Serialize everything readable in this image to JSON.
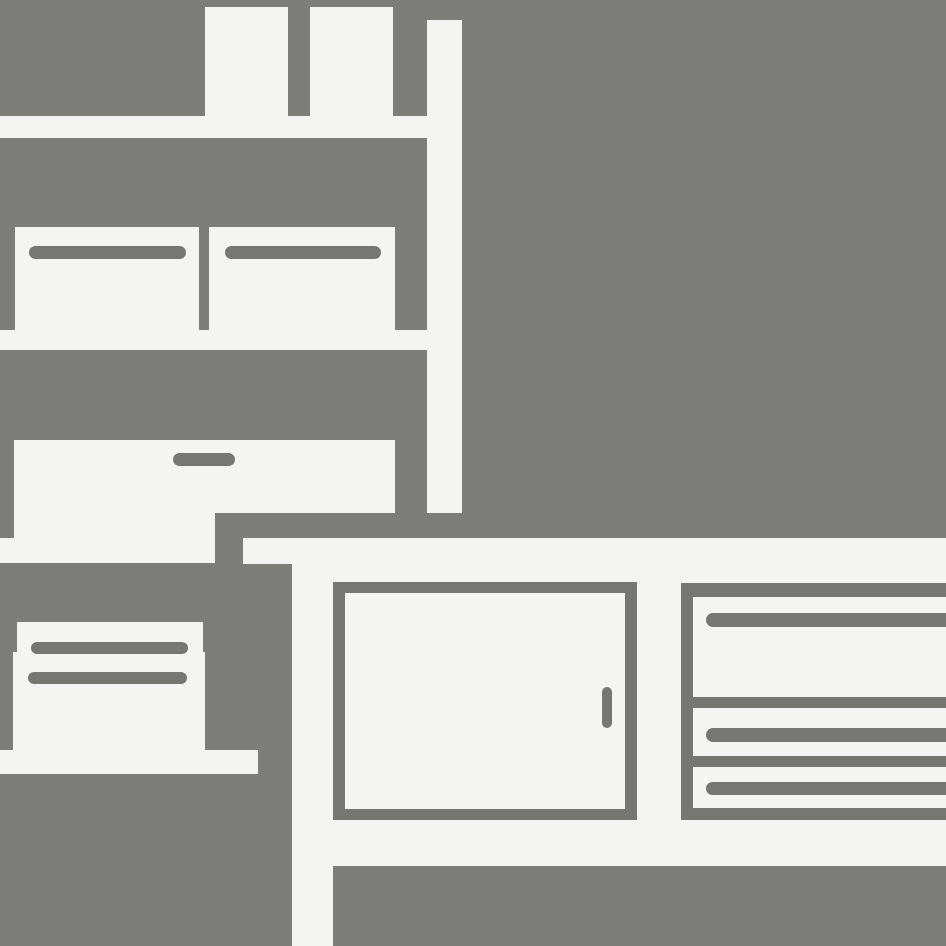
{
  "scene": {
    "description": "Flat grayscale pictogram of office furniture: bookshelf with books and storage boxes, a printer standing on the floor, and a sideboard cabinet with a hinged door and three drawers",
    "canvas": {
      "width": 946,
      "height": 946
    },
    "colors": {
      "background": "#7d7d7a",
      "shape": "#f4f4f2",
      "detail": "#767673"
    }
  },
  "objects": [
    {
      "group": "bookshelf",
      "name": "book-1",
      "fill": "shape",
      "x": 205,
      "y": 7,
      "w": 83,
      "h": 109,
      "r": "0"
    },
    {
      "group": "bookshelf",
      "name": "book-2",
      "fill": "shape",
      "x": 310,
      "y": 7,
      "w": 83,
      "h": 109,
      "r": "0"
    },
    {
      "group": "bookshelf",
      "name": "shelf-side-panel",
      "fill": "shape",
      "x": 427,
      "y": 20,
      "w": 35,
      "h": 493,
      "r": "0"
    },
    {
      "group": "bookshelf",
      "name": "shelf-board-upper",
      "fill": "shape",
      "x": 0,
      "y": 116,
      "w": 427,
      "h": 22,
      "r": "0"
    },
    {
      "group": "bookshelf",
      "name": "storage-box-left",
      "fill": "shape",
      "x": 15,
      "y": 227,
      "w": 184,
      "h": 103,
      "r": "0"
    },
    {
      "group": "bookshelf",
      "name": "storage-box-right",
      "fill": "shape",
      "x": 209,
      "y": 227,
      "w": 186,
      "h": 103,
      "r": "0"
    },
    {
      "group": "bookshelf",
      "name": "storage-box-left-slot",
      "fill": "detail",
      "x": 29,
      "y": 246,
      "w": 157,
      "h": 13,
      "r": "7px"
    },
    {
      "group": "bookshelf",
      "name": "storage-box-right-slot",
      "fill": "detail",
      "x": 225,
      "y": 246,
      "w": 156,
      "h": 13,
      "r": "7px"
    },
    {
      "group": "bookshelf",
      "name": "shelf-board-middle",
      "fill": "shape",
      "x": 0,
      "y": 330,
      "w": 427,
      "h": 20,
      "r": "0"
    },
    {
      "group": "bookshelf",
      "name": "drawer-chest",
      "fill": "shape",
      "x": 14,
      "y": 440,
      "w": 381,
      "h": 73,
      "r": "0"
    },
    {
      "group": "bookshelf",
      "name": "drawer-chest-left-extension",
      "fill": "shape",
      "x": 14,
      "y": 513,
      "w": 201,
      "h": 50,
      "r": "0"
    },
    {
      "group": "bookshelf",
      "name": "shelf-board-lower",
      "fill": "shape",
      "x": 0,
      "y": 538,
      "w": 215,
      "h": 25,
      "r": "0"
    },
    {
      "group": "bookshelf",
      "name": "drawer-chest-handle",
      "fill": "detail",
      "x": 173,
      "y": 453,
      "w": 62,
      "h": 13,
      "r": "7px"
    },
    {
      "group": "printer",
      "name": "printer-top-tray",
      "fill": "shape",
      "x": 17,
      "y": 622,
      "w": 186,
      "h": 31,
      "r": "0"
    },
    {
      "group": "printer",
      "name": "printer-body",
      "fill": "shape",
      "x": 13,
      "y": 652,
      "w": 192,
      "h": 98,
      "r": "0"
    },
    {
      "group": "printer",
      "name": "printer-slot-upper",
      "fill": "detail",
      "x": 31,
      "y": 642,
      "w": 157,
      "h": 12,
      "r": "6px"
    },
    {
      "group": "printer",
      "name": "printer-slot-lower",
      "fill": "detail",
      "x": 28,
      "y": 672,
      "w": 159,
      "h": 12,
      "r": "6px"
    },
    {
      "group": "printer",
      "name": "printer-base",
      "fill": "shape",
      "x": 0,
      "y": 750,
      "w": 258,
      "h": 24,
      "r": "0"
    },
    {
      "group": "sideboard",
      "name": "sideboard-top",
      "fill": "shape",
      "x": 243,
      "y": 538,
      "w": 703,
      "h": 26,
      "r": "0"
    },
    {
      "group": "sideboard",
      "name": "sideboard-leg",
      "fill": "shape",
      "x": 292,
      "y": 538,
      "w": 41,
      "h": 408,
      "r": "0"
    },
    {
      "group": "sideboard",
      "name": "sideboard-body",
      "fill": "shape",
      "x": 292,
      "y": 564,
      "w": 654,
      "h": 302,
      "r": "0"
    },
    {
      "group": "sideboard",
      "name": "cabinet-door-frame",
      "fill": "detail",
      "x": 333,
      "y": 582,
      "w": 304,
      "h": 238,
      "r": "0"
    },
    {
      "group": "sideboard",
      "name": "cabinet-door-panel",
      "fill": "shape",
      "x": 345,
      "y": 593,
      "w": 280,
      "h": 216,
      "r": "0"
    },
    {
      "group": "sideboard",
      "name": "cabinet-door-handle",
      "fill": "detail",
      "x": 602,
      "y": 687,
      "w": 10,
      "h": 41,
      "r": "5px"
    },
    {
      "group": "sideboard",
      "name": "drawer-section-left-border",
      "fill": "detail",
      "x": 681,
      "y": 583,
      "w": 12,
      "h": 237,
      "r": "0"
    },
    {
      "group": "sideboard",
      "name": "drawer-section-top-border",
      "fill": "detail",
      "x": 681,
      "y": 583,
      "w": 265,
      "h": 14,
      "r": "0"
    },
    {
      "group": "sideboard",
      "name": "drawer-section-bottom-border",
      "fill": "detail",
      "x": 681,
      "y": 808,
      "w": 265,
      "h": 12,
      "r": "0"
    },
    {
      "group": "sideboard",
      "name": "drawer-divider-upper",
      "fill": "detail",
      "x": 693,
      "y": 697,
      "w": 253,
      "h": 11,
      "r": "0"
    },
    {
      "group": "sideboard",
      "name": "drawer-divider-lower",
      "fill": "detail",
      "x": 693,
      "y": 756,
      "w": 253,
      "h": 11,
      "r": "0"
    },
    {
      "group": "sideboard",
      "name": "drawer-handle-top",
      "fill": "detail",
      "x": 706,
      "y": 613,
      "w": 240,
      "h": 14,
      "r": "7px 0 0 7px"
    },
    {
      "group": "sideboard",
      "name": "drawer-handle-middle",
      "fill": "detail",
      "x": 706,
      "y": 728,
      "w": 240,
      "h": 14,
      "r": "7px 0 0 7px"
    },
    {
      "group": "sideboard",
      "name": "drawer-handle-bottom",
      "fill": "detail",
      "x": 706,
      "y": 782,
      "w": 240,
      "h": 13,
      "r": "7px 0 0 7px"
    }
  ]
}
